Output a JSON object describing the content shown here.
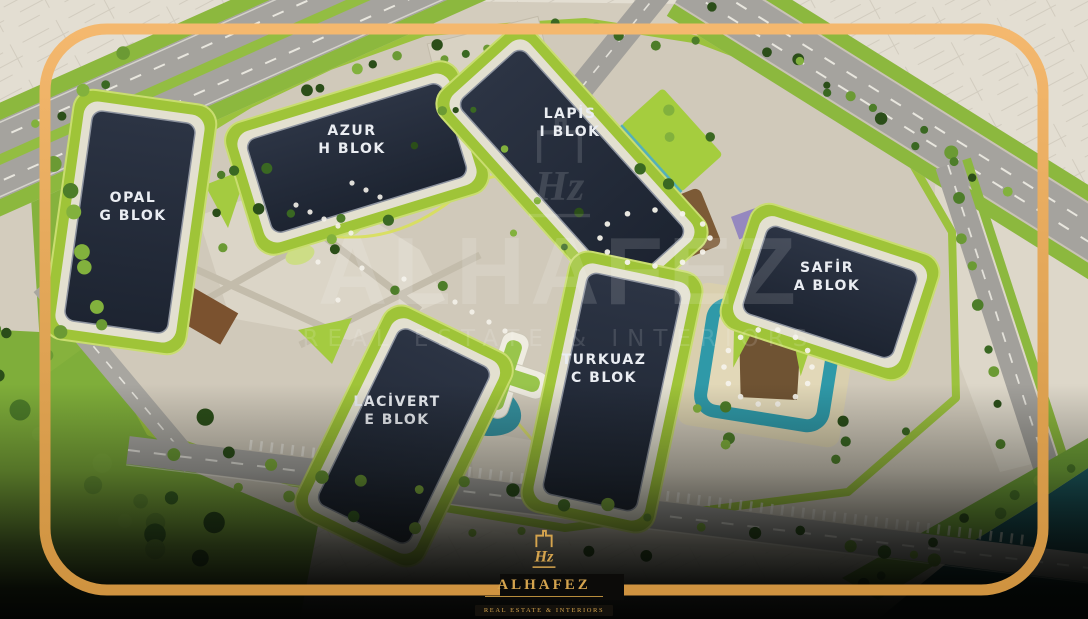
{
  "map": {
    "blocks": [
      {
        "id": "opal",
        "name": "OPAL",
        "block": "G BLOK"
      },
      {
        "id": "azur",
        "name": "AZUR",
        "block": "H BLOK"
      },
      {
        "id": "lapis",
        "name": "LAPİS",
        "block": "I BLOK"
      },
      {
        "id": "safir",
        "name": "SAFİR",
        "block": "A BLOK"
      },
      {
        "id": "turkuaz",
        "name": "TURKUAZ",
        "block": "C BLOK"
      },
      {
        "id": "lacivert",
        "name": "LACİVERT",
        "block": "E BLOK"
      }
    ]
  },
  "watermark": {
    "brand": "ALHAFEZ",
    "tagline": "REAL ESTATE & INTERIORS",
    "monogram": "Hz"
  },
  "logo": {
    "brand": "ALHAFEZ",
    "tagline": "REAL ESTATE & INTERIORS",
    "monogram": "Hz"
  },
  "colors": {
    "frame_gold": "#eeb066",
    "logo_gold": "#d5a44e",
    "block_navy": "#232b39",
    "terrace_lime": "#9fc438",
    "pool_teal": "#39a4b0",
    "canal_teal": "#10424a"
  }
}
